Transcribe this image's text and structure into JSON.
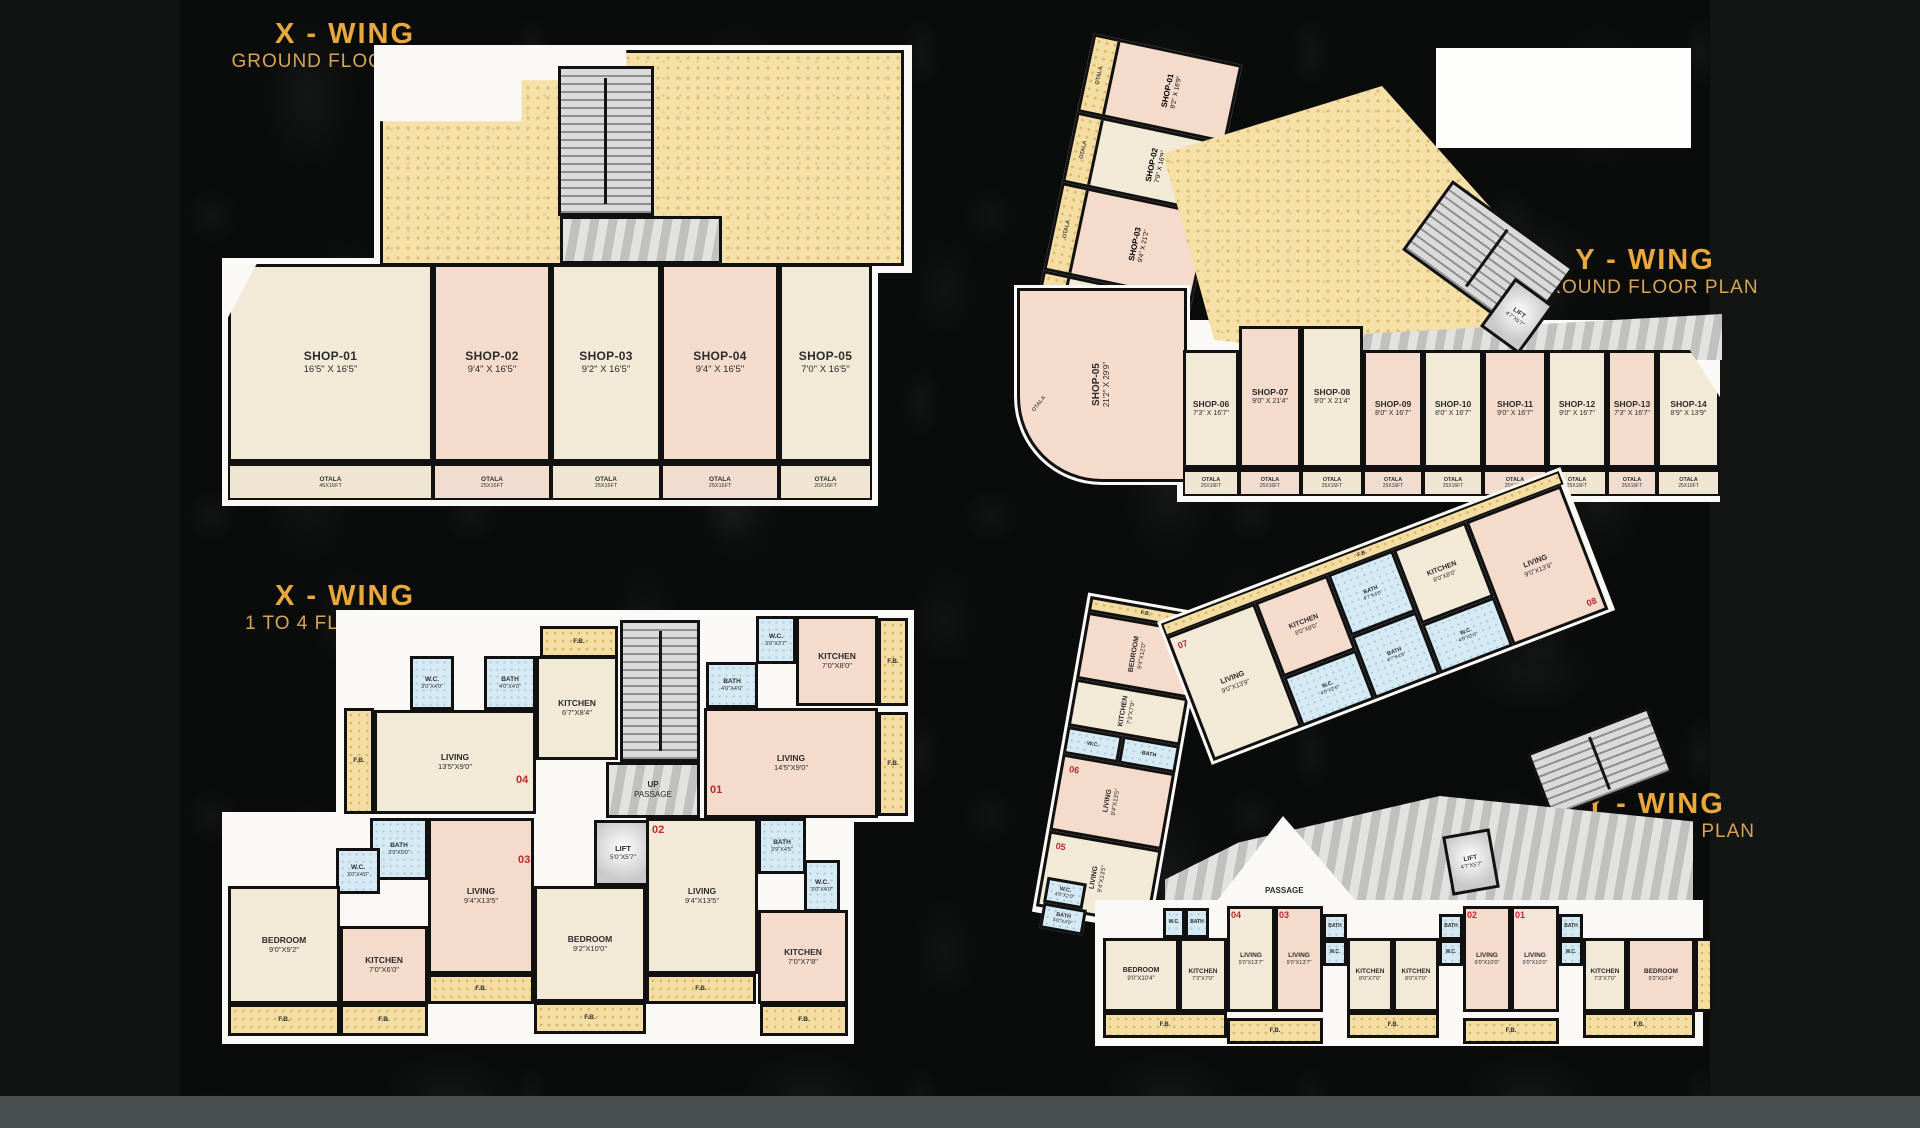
{
  "labels": {
    "fb": "F.B.",
    "otala": "OTALA",
    "otala_sub": "25X16FT",
    "up": "UP",
    "passage": "PASSAGE",
    "lift": "LIFT"
  },
  "colors": {
    "gold": "#E8A83E",
    "red": "#C0272D",
    "background": "#0a0c0c"
  },
  "x_ground": {
    "title": "X - WING",
    "subtitle": "GROUND FLOOR PLAN",
    "lift_dim": "5'0\"X5'7\"",
    "shops": [
      {
        "name": "SHOP-01",
        "dim": "16'5\" X 16'5\""
      },
      {
        "name": "SHOP-02",
        "dim": "9'4\" X 16'5\""
      },
      {
        "name": "SHOP-03",
        "dim": "9'2\" X 16'5\""
      },
      {
        "name": "SHOP-04",
        "dim": "9'4\" X 16'5\""
      },
      {
        "name": "SHOP-05",
        "dim": "7'0\" X 16'5\""
      }
    ],
    "otala_dims": [
      "46X16FT",
      "25X16FT",
      "25X16FT",
      "25X16FT",
      "20X16FT"
    ]
  },
  "y_ground": {
    "title": "Y - WING",
    "subtitle": "GROUND FLOOR PLAN",
    "lift_dim": "4'7\"X5'7\"",
    "side_shops": [
      {
        "name": "SHOP-01",
        "dim": "9'2\" X 16'9\""
      },
      {
        "name": "SHOP-02",
        "dim": "7'9\" X 16'9\""
      },
      {
        "name": "SHOP-03",
        "dim": "9'4\" X 21'2\""
      },
      {
        "name": "SHOP-04",
        "dim": "9'4\" X 21'2\""
      }
    ],
    "corner_shop": {
      "name": "SHOP-05",
      "dim": "21'2\" X 29'9\""
    },
    "row_shops": [
      {
        "name": "SHOP-06",
        "dim": "7'3\" X 16'7\""
      },
      {
        "name": "SHOP-07",
        "dim": "9'0\" X 21'4\""
      },
      {
        "name": "SHOP-08",
        "dim": "9'0\" X 21'4\""
      },
      {
        "name": "SHOP-09",
        "dim": "8'0\" X 16'7\""
      },
      {
        "name": "SHOP-10",
        "dim": "8'0\" X 16'7\""
      },
      {
        "name": "SHOP-11",
        "dim": "9'0\" X 16'7\""
      },
      {
        "name": "SHOP-12",
        "dim": "9'0\" X 16'7\""
      },
      {
        "name": "SHOP-13",
        "dim": "7'3\" X 16'7\""
      },
      {
        "name": "SHOP-14",
        "dim": "8'9\" X 13'9\""
      }
    ]
  },
  "x_floor": {
    "title": "X - WING",
    "subtitle": "1 TO 4 FLOOR PLAN",
    "lift_dim": "5'0\"X5'7\"",
    "units": {
      "u1": "01",
      "u2": "02",
      "u3": "03",
      "u4": "04"
    },
    "rooms": {
      "wc4": {
        "name": "W.C.",
        "dim": "3'0\"X4'0\""
      },
      "bath4": {
        "name": "BATH",
        "dim": "4'0\"X4'0\""
      },
      "kitchen4": {
        "name": "KITCHEN",
        "dim": "6'7\"X8'4\""
      },
      "living4": {
        "name": "LIVING",
        "dim": "13'5\"X9'0\""
      },
      "wc1": {
        "name": "W.C.",
        "dim": "3'0\"X3'7\""
      },
      "bath1": {
        "name": "BATH",
        "dim": "4'0\"X4'0\""
      },
      "kitchen1": {
        "name": "KITCHEN",
        "dim": "7'0\"X8'0\""
      },
      "living1": {
        "name": "LIVING",
        "dim": "14'5\"X9'0\""
      },
      "bath3": {
        "name": "BATH",
        "dim": "3'9\"X5'0\""
      },
      "wc3": {
        "name": "W.C.",
        "dim": "3'0\"X4'0\""
      },
      "bedroom3": {
        "name": "BEDROOM",
        "dim": "9'0\"X9'2\""
      },
      "kitchen3": {
        "name": "KITCHEN",
        "dim": "7'0\"X6'0\""
      },
      "living3": {
        "name": "LIVING",
        "dim": "9'4\"X13'5\""
      },
      "living2": {
        "name": "LIVING",
        "dim": "9'4\"X13'5\""
      },
      "bath2": {
        "name": "BATH",
        "dim": "3'9\"X4'5\""
      },
      "wc2": {
        "name": "W.C.",
        "dim": "3'0\"X4'0\""
      },
      "kitchen2": {
        "name": "KITCHEN",
        "dim": "7'0\"X7'8\""
      },
      "bedroom2": {
        "name": "BEDROOM",
        "dim": "9'2\"X10'0\""
      }
    }
  },
  "y_floor": {
    "title": "Y - WING",
    "subtitle": "1 TO 4 FLOOR PLAN",
    "lift_dim": "4'7\"X5'7\"",
    "units": {
      "u1": "01",
      "u2": "02",
      "u3": "03",
      "u4": "04",
      "u5": "05",
      "u6": "06",
      "u7": "07",
      "u8": "08"
    },
    "rooms": {
      "bedroom6": {
        "name": "BEDROOM",
        "dim": "9'4\"X12'0\""
      },
      "kitchen6": {
        "name": "KITCHEN",
        "dim": "7'3\"X7'9\""
      },
      "wc6": {
        "name": "W.C.",
        "dim": "4'0\"X3'9\""
      },
      "bath6": {
        "name": "BATH",
        "dim": "4'0\"X4'0\""
      },
      "living6": {
        "name": "LIVING",
        "dim": "9'4\"X13'5\""
      },
      "living5": {
        "name": "LIVING",
        "dim": "9'4\"X13'5\""
      },
      "wcj": {
        "name": "W.C.",
        "dim": "4'0\"X2'0\""
      },
      "bathj": {
        "name": "BATH",
        "dim": "4'0\"X4'0\""
      },
      "living7": {
        "name": "LIVING",
        "dim": "9'0\"X13'9\""
      },
      "kitchen7": {
        "name": "KITCHEN",
        "dim": "8'0\"X8'0\""
      },
      "wc7": {
        "name": "W.C.",
        "dim": "4'0\"X2'6\""
      },
      "bath7": {
        "name": "BATH",
        "dim": "4'7\"X4'0\""
      },
      "bath8": {
        "name": "BATH",
        "dim": "4'7\"X4'0\""
      },
      "wc8": {
        "name": "W.C.",
        "dim": "4'0\"X2'6\""
      },
      "kitchen8": {
        "name": "KITCHEN",
        "dim": "8'0\"X8'0\""
      },
      "living8": {
        "name": "LIVING",
        "dim": "9'0\"X13'9\""
      },
      "bedroom04": {
        "name": "BEDROOM",
        "dim": "9'0\"X10'4\""
      },
      "kitchen04": {
        "name": "KITCHEN",
        "dim": "7'3\"X7'0\""
      },
      "wc04": {
        "name": "W.C.",
        "dim": "4'0\"X3'6\""
      },
      "bath04": {
        "name": "BATH",
        "dim": "4'0\"X4'0\""
      },
      "living04": {
        "name": "LIVING",
        "dim": "9'0\"X13'7\""
      },
      "living03": {
        "name": "LIVING",
        "dim": "9'0\"X13'7\""
      },
      "bath03": {
        "name": "BATH",
        "dim": "4'0\"X4'0\""
      },
      "wc03": {
        "name": "W.C.",
        "dim": "4'0\"X2'0\""
      },
      "kitchen03": {
        "name": "KITCHEN",
        "dim": "8'0\"X7'0\""
      },
      "kitchen02": {
        "name": "KITCHEN",
        "dim": "8'0\"X7'0\""
      },
      "bath02": {
        "name": "BATH",
        "dim": "4'0\"X4'0\""
      },
      "wc02": {
        "name": "W.C.",
        "dim": "4'0\"X2'0\""
      },
      "living02": {
        "name": "LIVING",
        "dim": "9'0\"X10'0\""
      },
      "living01": {
        "name": "LIVING",
        "dim": "9'0\"X10'0\""
      },
      "bath01": {
        "name": "BATH",
        "dim": "4'0\"X4'0\""
      },
      "wc01": {
        "name": "W.C.",
        "dim": "4'0\"X2'0\""
      },
      "kitchen01": {
        "name": "KITCHEN",
        "dim": "7'3\"X7'0\""
      },
      "bedroom01": {
        "name": "BEDROOM",
        "dim": "9'2\"X10'4\""
      }
    }
  }
}
